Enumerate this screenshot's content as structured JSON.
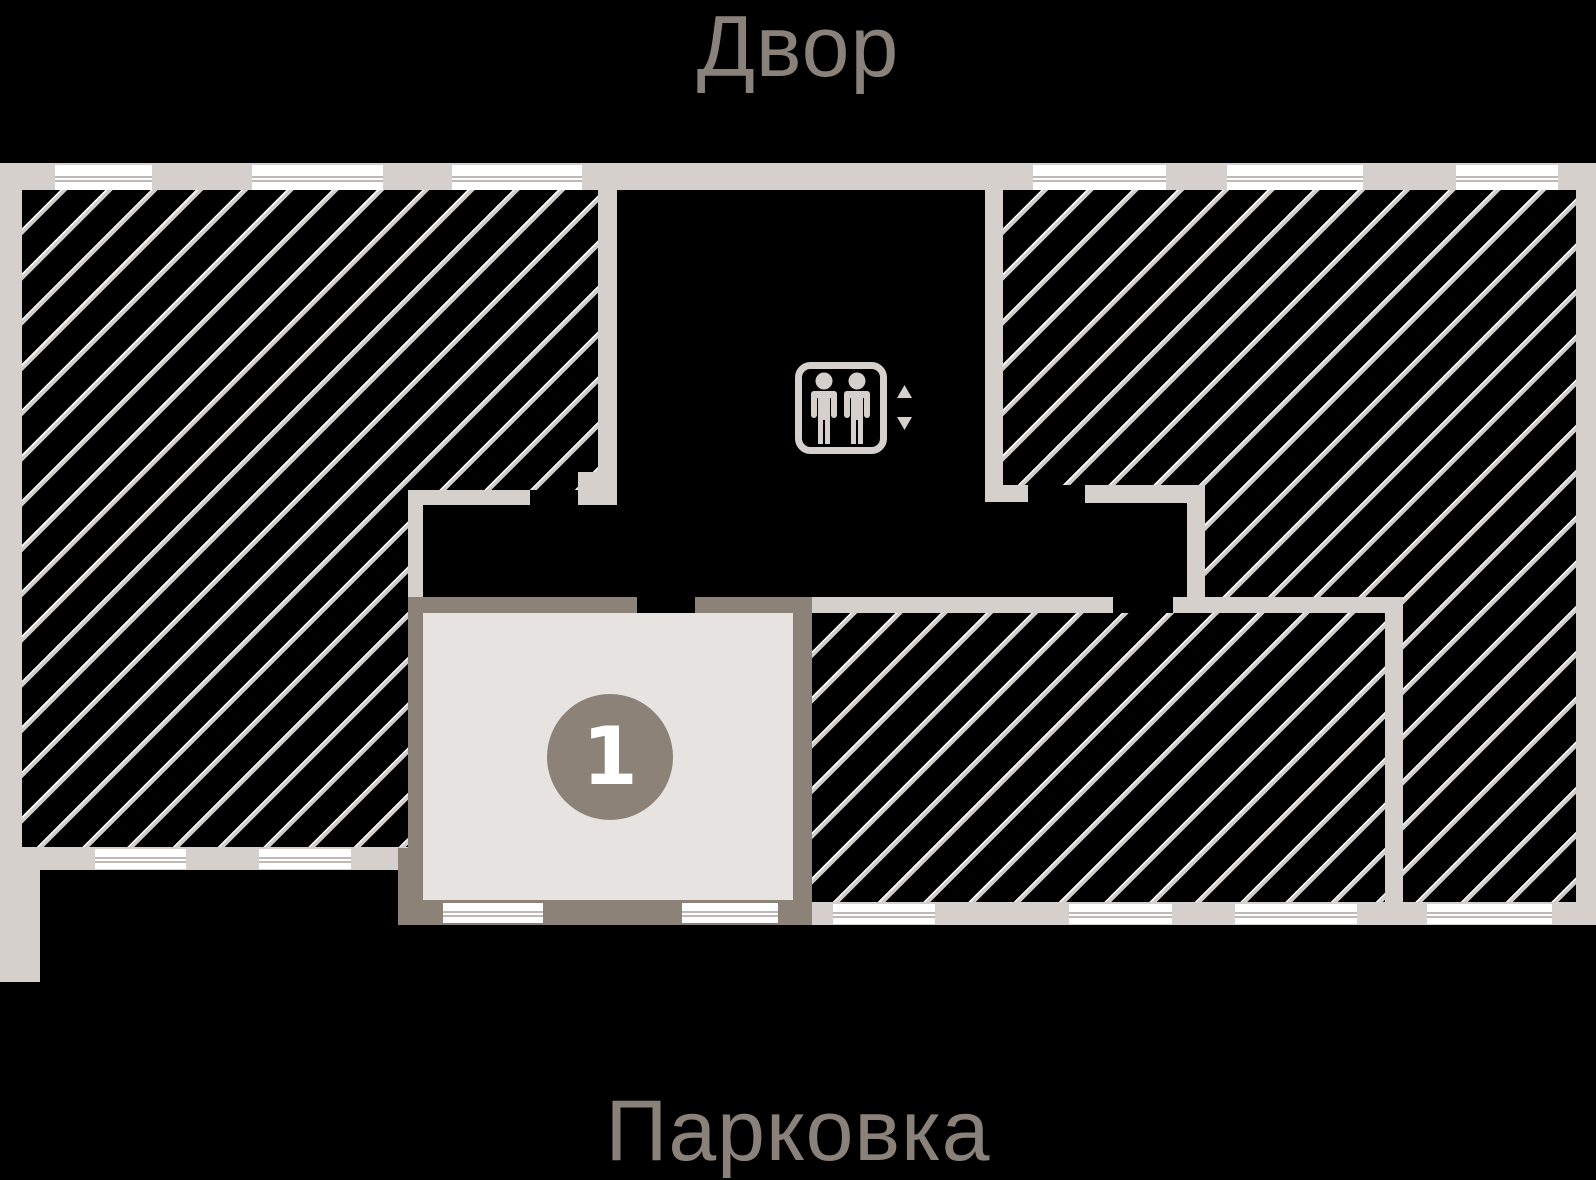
{
  "labels": {
    "courtyard": "Двор",
    "parking": "Парковка"
  },
  "unit": {
    "number": "1"
  },
  "elevator": {
    "icon_name": "elevator-people-up-down-icon"
  },
  "colors": {
    "background": "#000000",
    "wall_light": "#d5d0cb",
    "wall_dark": "#8c8278",
    "hatch_line": "#d2cdc8",
    "hatch_highlight": "#ffffff",
    "window_fill": "#ffffff",
    "window_line": "#beb9b4",
    "unit_fill": "#e6e3e0",
    "badge_fill": "#8c8278",
    "badge_text": "#ffffff",
    "label_text": "#8a817a"
  }
}
